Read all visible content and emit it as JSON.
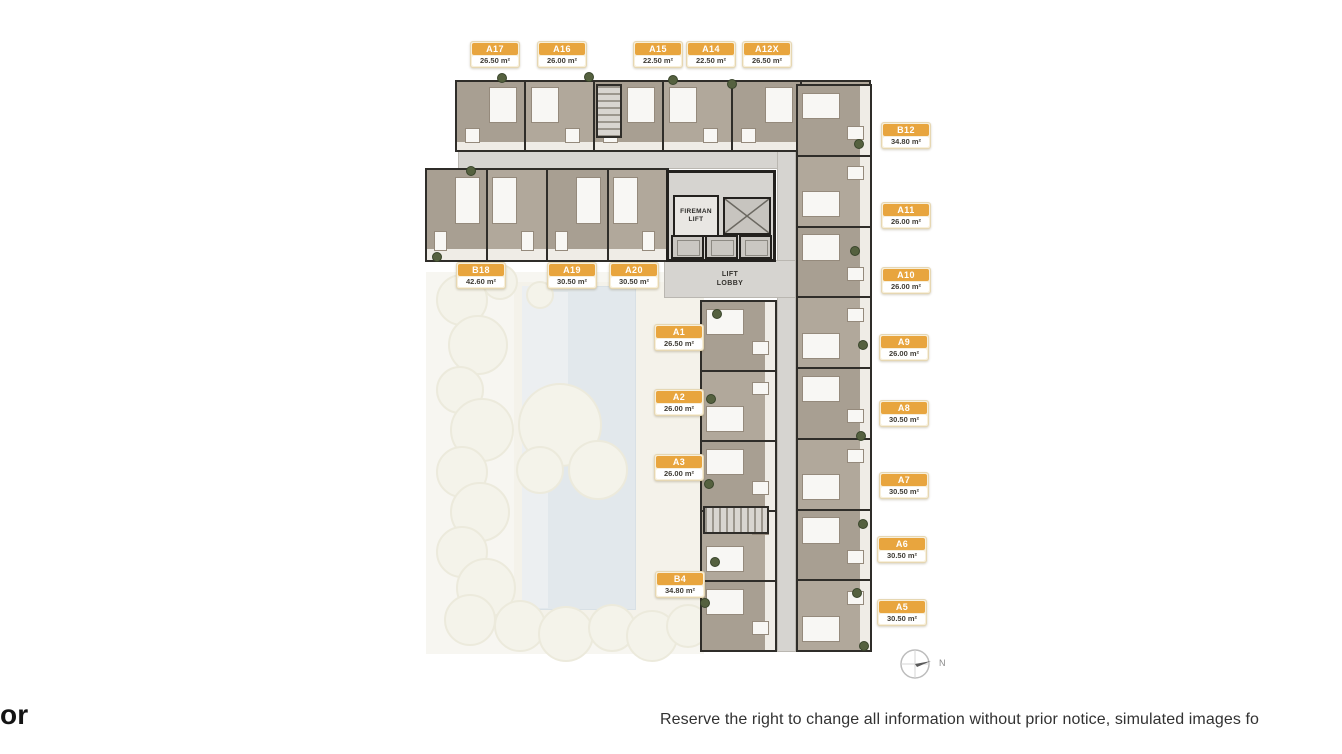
{
  "heading_fragment": "or",
  "disclaimer": "Reserve the right to change all information without prior notice, simulated images fo",
  "compass": {
    "label": "N"
  },
  "core": {
    "fireman_lift": "FIREMAN\nLIFT",
    "lift_lobby": "LIFT\nLOBBY"
  },
  "colors": {
    "badge_accent": "#E8A53E",
    "pool": "#CCD6DE",
    "unit_fill": "#A89F92",
    "corridor": "#D6D4D0",
    "wall": "#2F2D29"
  },
  "units": [
    {
      "id": "A17",
      "area": "26.50 m²",
      "x": 470,
      "y": 41
    },
    {
      "id": "A16",
      "area": "26.00 m²",
      "x": 537,
      "y": 41
    },
    {
      "id": "A15",
      "area": "22.50 m²",
      "x": 633,
      "y": 41
    },
    {
      "id": "A14",
      "area": "22.50 m²",
      "x": 686,
      "y": 41
    },
    {
      "id": "A12X",
      "area": "26.50 m²",
      "x": 742,
      "y": 41
    },
    {
      "id": "B12",
      "area": "34.80 m²",
      "x": 881,
      "y": 122
    },
    {
      "id": "A11",
      "area": "26.00 m²",
      "x": 881,
      "y": 202
    },
    {
      "id": "A10",
      "area": "26.00 m²",
      "x": 881,
      "y": 267
    },
    {
      "id": "A9",
      "area": "26.00 m²",
      "x": 879,
      "y": 334
    },
    {
      "id": "A8",
      "area": "30.50 m²",
      "x": 879,
      "y": 400
    },
    {
      "id": "A7",
      "area": "30.50 m²",
      "x": 879,
      "y": 472
    },
    {
      "id": "A6",
      "area": "30.50 m²",
      "x": 877,
      "y": 536
    },
    {
      "id": "A5",
      "area": "30.50 m²",
      "x": 877,
      "y": 599
    },
    {
      "id": "B18",
      "area": "42.60 m²",
      "x": 456,
      "y": 262
    },
    {
      "id": "A19",
      "area": "30.50 m²",
      "x": 547,
      "y": 262
    },
    {
      "id": "A20",
      "area": "30.50 m²",
      "x": 609,
      "y": 262
    },
    {
      "id": "A1",
      "area": "26.50 m²",
      "x": 654,
      "y": 324
    },
    {
      "id": "A2",
      "area": "26.00 m²",
      "x": 654,
      "y": 389
    },
    {
      "id": "A3",
      "area": "26.00 m²",
      "x": 654,
      "y": 454
    },
    {
      "id": "B4",
      "area": "34.80 m²",
      "x": 655,
      "y": 571
    }
  ]
}
